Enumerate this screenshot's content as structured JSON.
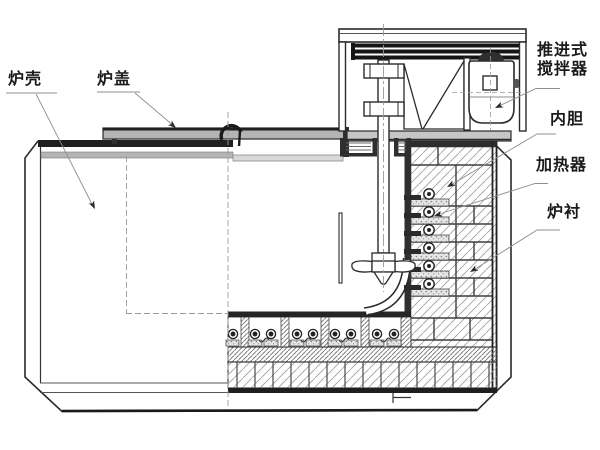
{
  "labels": {
    "shell": {
      "text": "炉壳"
    },
    "lid": {
      "text": "炉盖"
    },
    "agitator": {
      "line1": "推进式",
      "line2": "搅拌器"
    },
    "inner_liner": {
      "text": "内胆"
    },
    "heater": {
      "text": "加热器"
    },
    "furnace_lining": {
      "text": "炉衬"
    }
  },
  "colors": {
    "ink": "#1f1f1f",
    "leader_line": "#8f8f8f",
    "lid_fill": "#b4b4b4",
    "plate_fill": "#c6c6c6",
    "dark_fill": "#2e2e2e",
    "paper": "#ffffff"
  }
}
